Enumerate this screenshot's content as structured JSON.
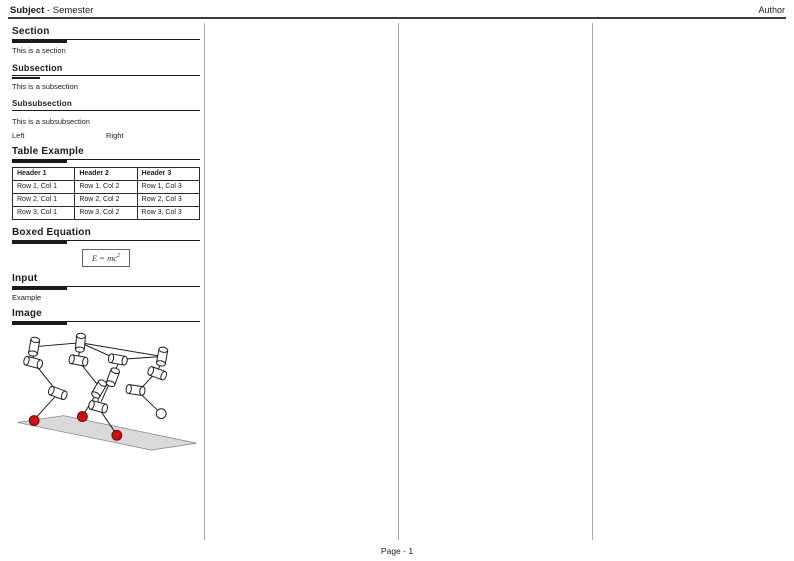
{
  "page": {
    "header": {
      "subject": "Subject",
      "separator": " - ",
      "semester": "Semester",
      "author": "Author"
    },
    "footer": {
      "page_label": "Page - 1"
    }
  },
  "left_column": {
    "section": {
      "heading": "Section",
      "body": "This is a section"
    },
    "subsection": {
      "heading": "Subsection",
      "body": "This is a subsection"
    },
    "subsubsection": {
      "heading": "Subsubsection",
      "body": "This is a subsubsection"
    },
    "minipage": {
      "left": "Left",
      "right": "Right"
    },
    "table_example": {
      "heading": "Table Example",
      "headers": [
        "Header 1",
        "Header 2",
        "Header 3"
      ],
      "rows": [
        [
          "Row 1, Col 1",
          "Row 1, Col 2",
          "Row 1, Col 3"
        ],
        [
          "Row 2, Col 1",
          "Row 2, Col 2",
          "Row 2, Col 3"
        ],
        [
          "Row 3, Col 1",
          "Row 3, Col 2",
          "Row 3, Col 3"
        ]
      ]
    },
    "boxed_equation": {
      "heading": "Boxed Equation",
      "base": "E = mc",
      "exponent": "2"
    },
    "input": {
      "heading": "Input",
      "body": "Example"
    },
    "image": {
      "heading": "Image"
    }
  },
  "figure": {
    "name": "quadruped-robot-diagram",
    "colors": {
      "foot_contact": "#cc1111",
      "foot_swing": "#ffffff",
      "ground_plane": "#d9d9d9",
      "outline": "#1a1a1a"
    }
  }
}
